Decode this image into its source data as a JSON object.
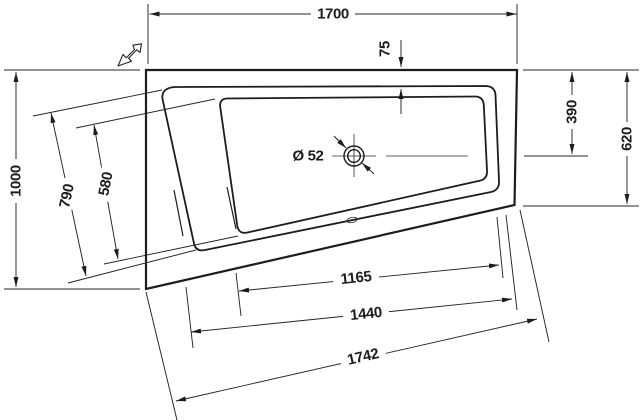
{
  "drawing": {
    "type": "technical-drawing-bathtub-top-view",
    "background_color": "#ffffff",
    "line_color": "#1d1d1b",
    "icons": {
      "view_direction": "view-direction-arrow",
      "drain": "drain-crosshair-circle"
    },
    "dimensions": {
      "overall_width": "1700",
      "overall_depth": "1000",
      "rim_width_top": "75",
      "drain_center_from_top": "390",
      "right_side_depth": "620",
      "head_end_inner_width_rim": "790",
      "head_end_inner_width_basin": "580",
      "drain_diameter": "Ø 52",
      "slant_length_basin_inner": "1165",
      "slant_length_rim": "1440",
      "slant_length_overall": "1742"
    }
  }
}
